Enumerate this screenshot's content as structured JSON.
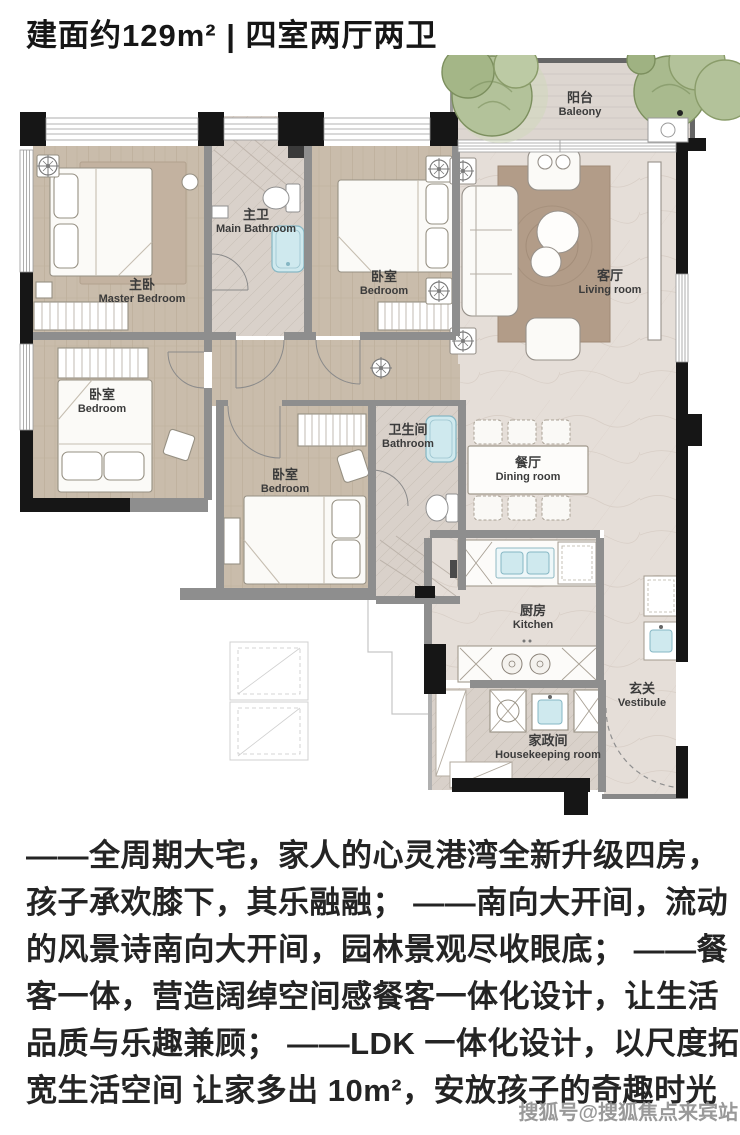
{
  "header": {
    "title": "建面约129m² | 四室两厅两卫"
  },
  "floorplan": {
    "rooms": [
      {
        "key": "balcony",
        "zh": "阳台",
        "en": "Baleony"
      },
      {
        "key": "main-bathroom",
        "zh": "主卫",
        "en": "Main Bathroom"
      },
      {
        "key": "master-bedroom",
        "zh": "主卧",
        "en": "Master Bedroom"
      },
      {
        "key": "bedroom-north",
        "zh": "卧室",
        "en": "Bedroom"
      },
      {
        "key": "living-room",
        "zh": "客厅",
        "en": "Living room"
      },
      {
        "key": "bedroom-west",
        "zh": "卧室",
        "en": "Bedroom"
      },
      {
        "key": "bedroom-middle",
        "zh": "卧室",
        "en": "Bedroom"
      },
      {
        "key": "bathroom",
        "zh": "卫生间",
        "en": "Bathroom"
      },
      {
        "key": "dining-room",
        "zh": "餐厅",
        "en": "Dining room"
      },
      {
        "key": "kitchen",
        "zh": "厨房",
        "en": "Kitchen"
      },
      {
        "key": "vestibule",
        "zh": "玄关",
        "en": "Vestibule"
      },
      {
        "key": "housekeeping-room",
        "zh": "家政间",
        "en": "Housekeeping room"
      }
    ]
  },
  "description": {
    "lines": [
      "——全周期大宅，家人的心灵港湾全新升级四房，",
      "孩子承欢膝下，其乐融融； ——南向大开间，流动",
      "的风景诗南向大开间，园林景观尽收眼底； ——餐",
      "客一体，营造阔绰空间感餐客一体化设计，让生活",
      "品质与乐趣兼顾； ——LDK 一体化设计，以尺度拓",
      "宽生活空间 让家多出 10m²，安放孩子的奇趣时光"
    ]
  },
  "watermark": {
    "text": "搜狐号@搜狐焦点来宾站"
  },
  "colors": {
    "wall": "#161616",
    "interior_wall": "#8e8e8e",
    "wood_floor": "#c9bcab",
    "marble_floor": "#e5ded8",
    "tile_floor": "#d9d1ca",
    "water_fixture": "#cfe9ee",
    "tree": "#a9ba8e",
    "rug": "#b29c88",
    "text": "#242424",
    "watermark": "#8f8f8f"
  }
}
